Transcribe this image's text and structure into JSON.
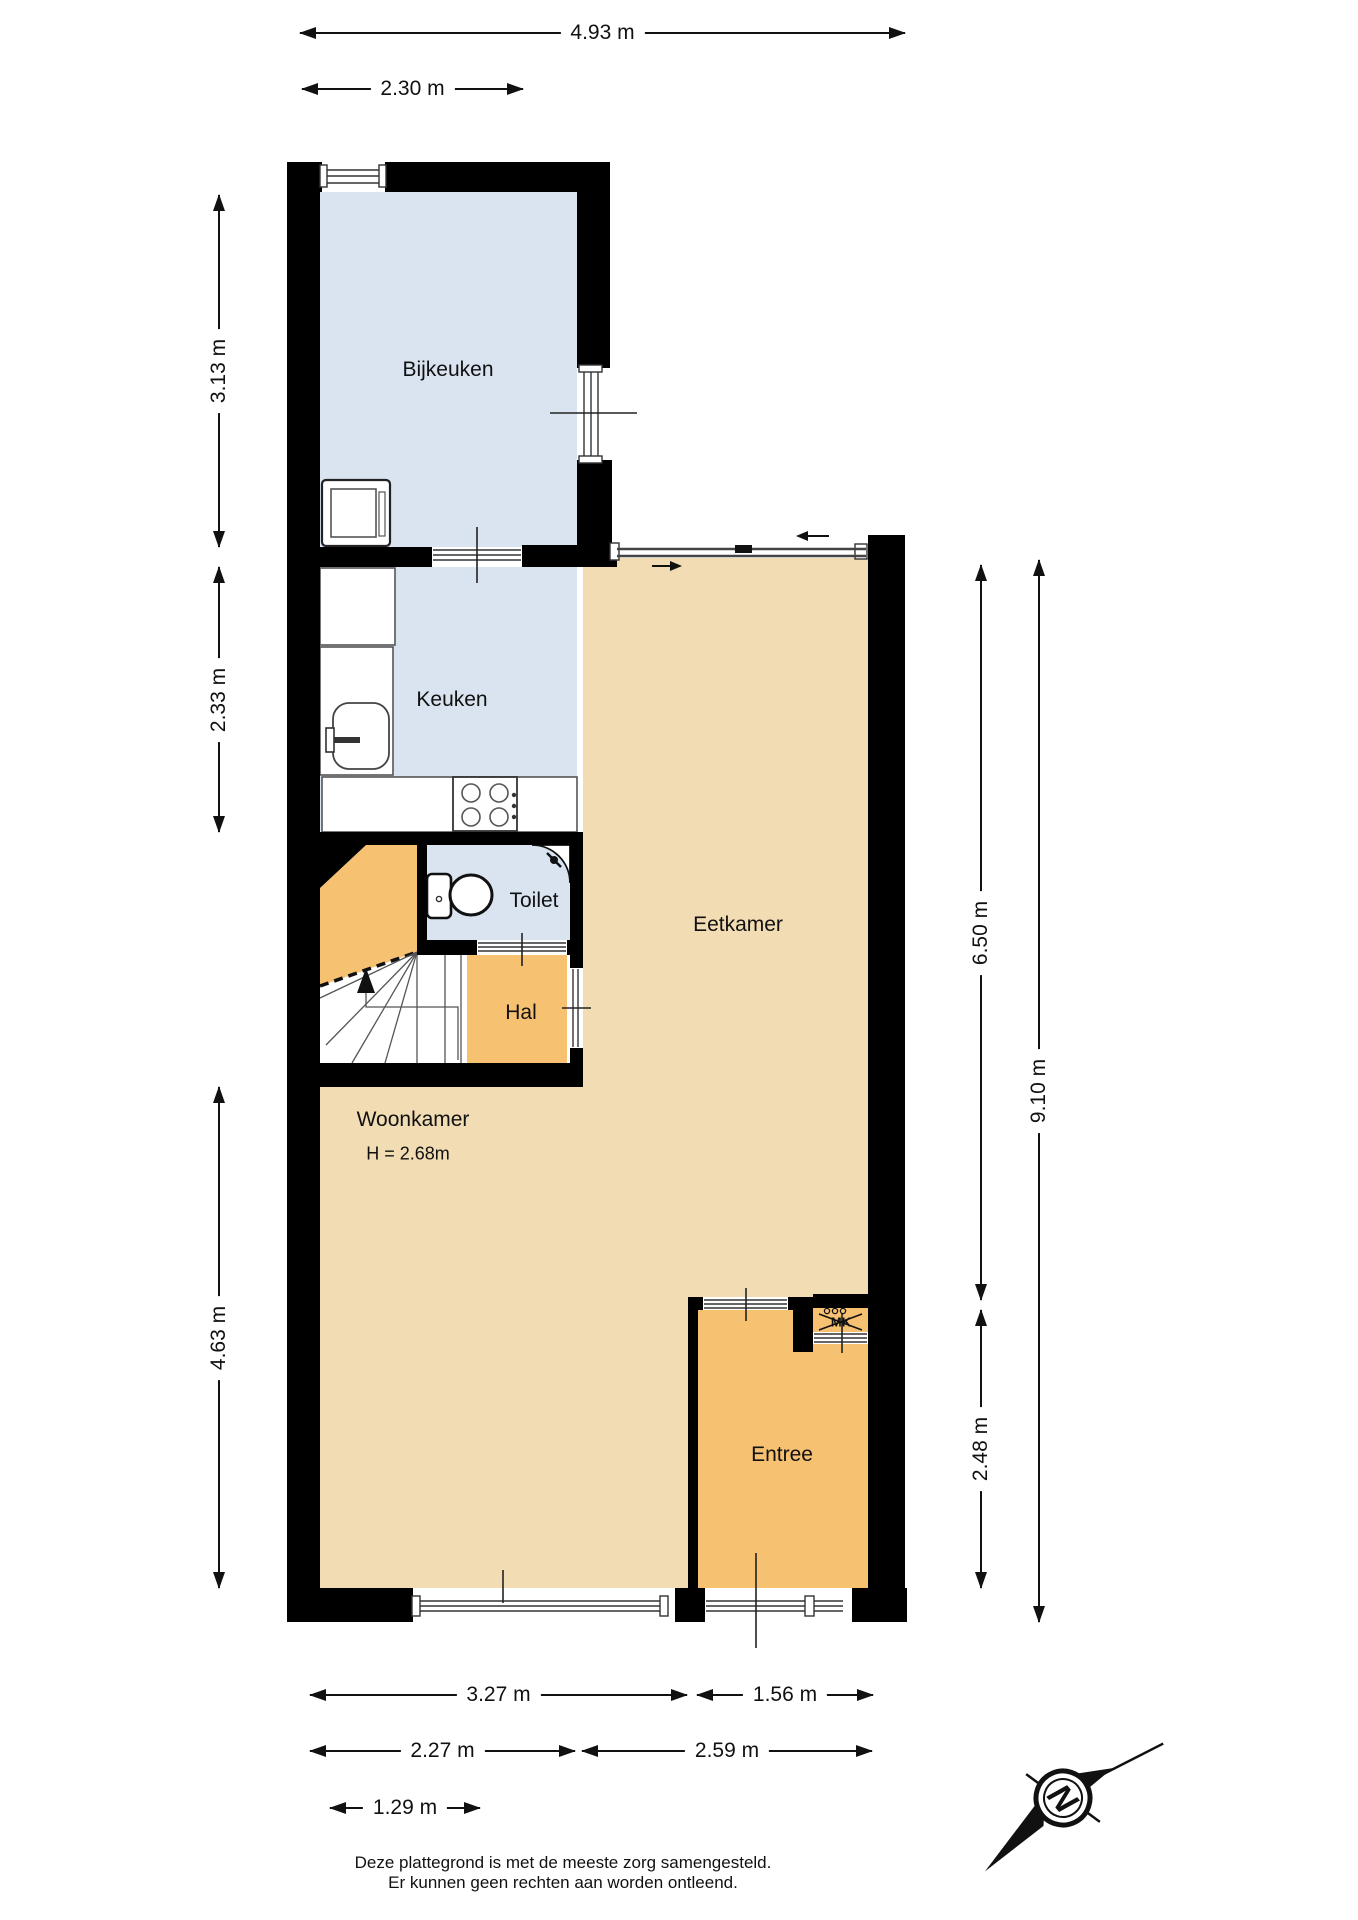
{
  "plan": {
    "rooms": {
      "bijkeuken": {
        "label": "Bijkeuken"
      },
      "keuken": {
        "label": "Keuken"
      },
      "toilet": {
        "label": "Toilet"
      },
      "hal": {
        "label": "Hal"
      },
      "eetkamer": {
        "label": "Eetkamer"
      },
      "woonkamer": {
        "label": "Woonkamer",
        "height_note": "H = 2.68m"
      },
      "entree": {
        "label": "Entree"
      },
      "meterkast": {
        "label": "MK"
      }
    },
    "compass": {
      "north_label": "N"
    }
  },
  "dimensions": {
    "top": [
      {
        "label": "4.93 m"
      },
      {
        "label": "2.30 m"
      }
    ],
    "left": [
      {
        "label": "3.13 m"
      },
      {
        "label": "2.33 m"
      },
      {
        "label": "4.63 m"
      }
    ],
    "right": [
      {
        "label": "6.50 m"
      },
      {
        "label": "9.10 m"
      },
      {
        "label": "2.48 m"
      }
    ],
    "bottom": [
      {
        "label": "3.27 m"
      },
      {
        "label": "1.56 m"
      },
      {
        "label": "2.27 m"
      },
      {
        "label": "2.59 m"
      },
      {
        "label": "1.29 m"
      }
    ]
  },
  "footer": {
    "line1": "Deze plattegrond is met de meeste zorg samengesteld.",
    "line2": "Er kunnen geen rechten aan worden ontleend."
  },
  "colors": {
    "wall": "#000000",
    "room_blue": "#d9e4f0",
    "room_tan": "#f1dcb4",
    "room_orange": "#f7c172",
    "line": "#333333"
  }
}
